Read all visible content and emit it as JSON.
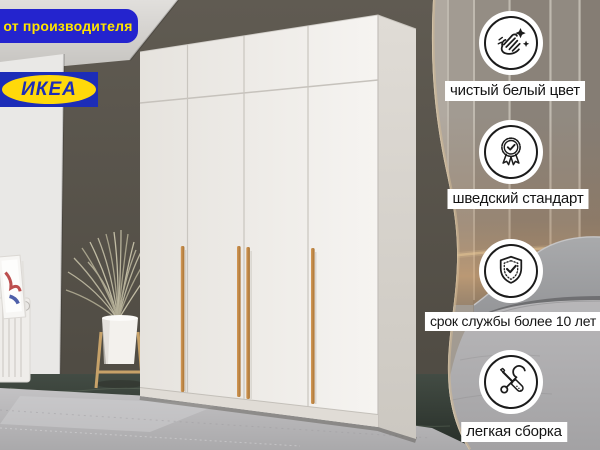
{
  "badge": {
    "label": "от производителя"
  },
  "logo": {
    "label": "ИКЕА"
  },
  "features": [
    {
      "icon": "clean-hands-icon",
      "label": "чистый белый цвет"
    },
    {
      "icon": "medal-check-icon",
      "label": "шведский стандарт"
    },
    {
      "icon": "shield-check-icon",
      "label": "срок службы более 10 лет"
    },
    {
      "icon": "tools-icon",
      "label": "легкая сборка"
    }
  ],
  "colors": {
    "badge_bg": "#2424ce",
    "badge_text": "#ffe400",
    "logo_bg": "#1c2db8",
    "logo_ellipse": "#ffd90a",
    "handle_wood": "#c08a4b",
    "label_bg": "#ffffff",
    "label_text": "#141414",
    "accent_wall": "#57534b",
    "wardrobe_white": "#f2f0ed"
  }
}
